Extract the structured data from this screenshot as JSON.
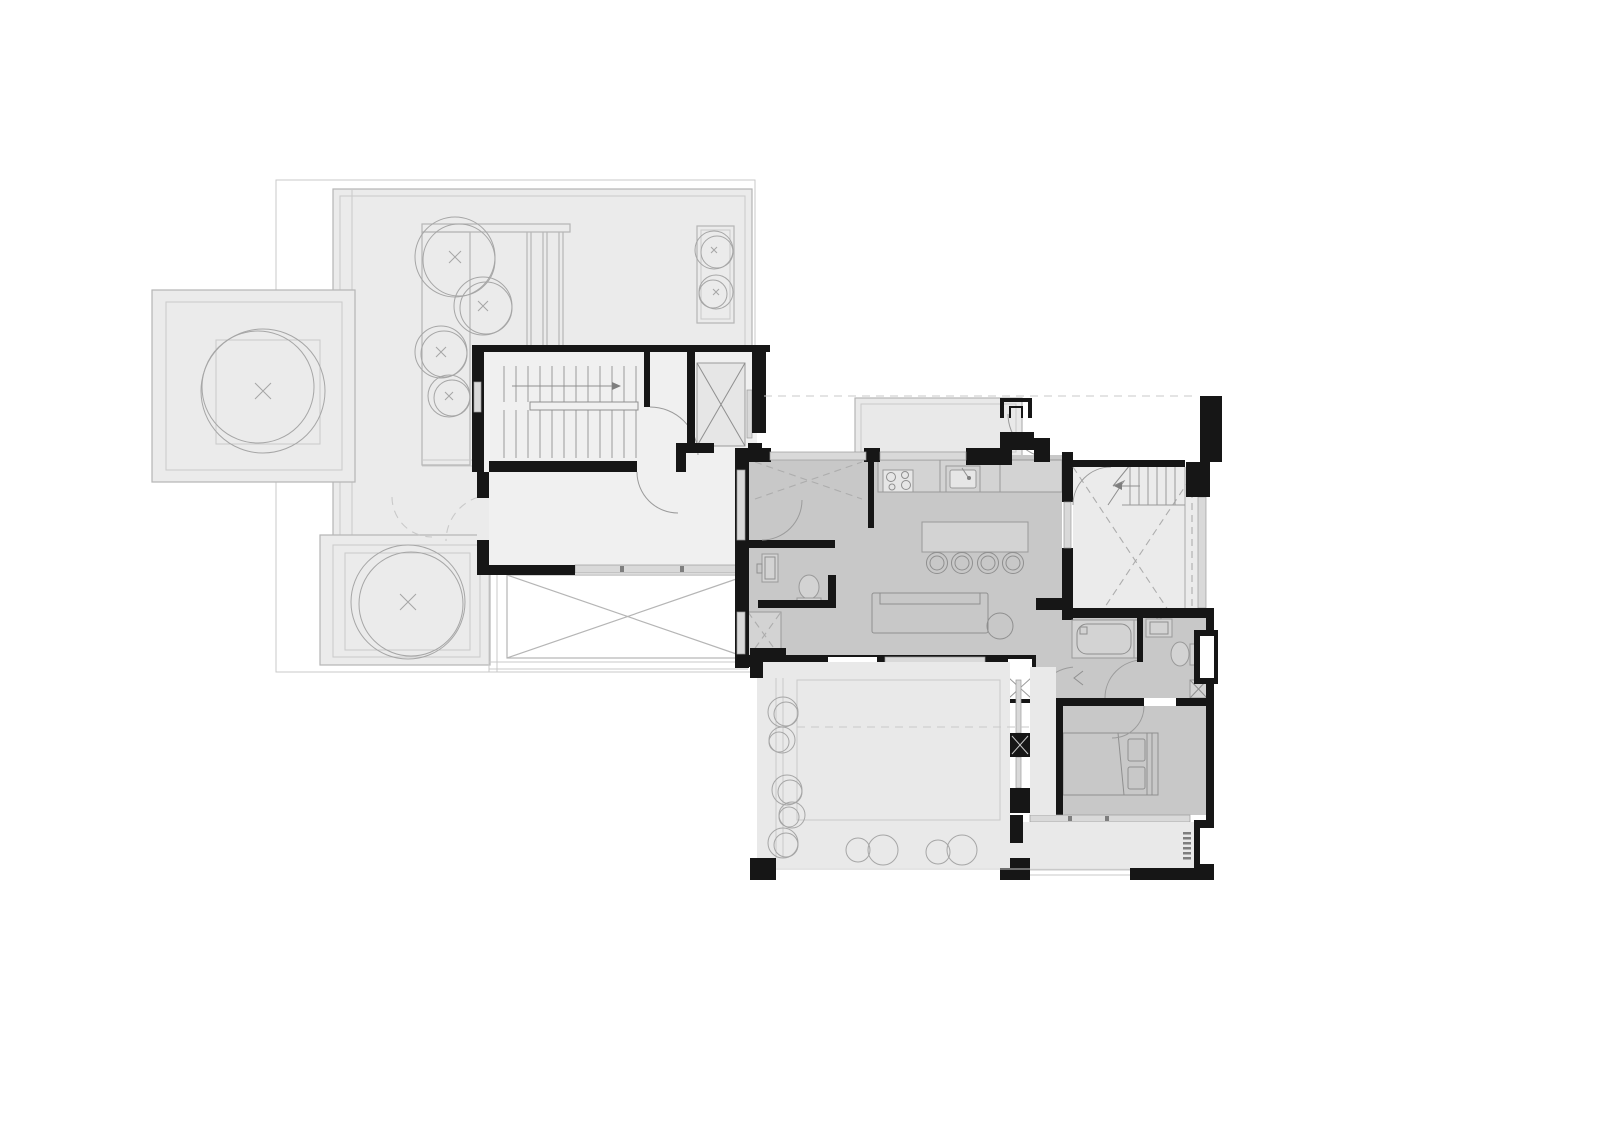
{
  "document": {
    "kind": "architectural-floor-plan",
    "visible_text": "none",
    "sheet": {
      "width_px": 1600,
      "height_px": 1131
    }
  },
  "palette": {
    "page_bg": "#ffffff",
    "wall": "#161616",
    "white": "#ffffff",
    "light_fill": "#ebebeb",
    "mid_fill": "#e9e9e9",
    "core_fill": "#f0f0f0",
    "dark_fill": "#c8c8c8",
    "deck_fill": "#efefef",
    "fixture_fill": "#d3d3d3",
    "fixture_light": "#e6e6e6",
    "band_fill": "#d9d9d9",
    "outline": "#b5b5b5",
    "faint": "#c9c9c9",
    "line": "#9a9a9a",
    "fixline": "#8f8f8f",
    "dash": "#adadad",
    "arcline": "#9b9b9b",
    "tree": "#a6a6a6"
  },
  "symbols": [
    "tree-canopy-circle-with-x",
    "planter-box",
    "pergola-slats",
    "stair-flight-with-up-arrow",
    "elevator-shaft-cross",
    "door-swing-arc",
    "dashed-roof-overhang-line",
    "skylight-cross",
    "double-height-void-dashed-cross",
    "break-line-zigzag",
    "kitchen-counter",
    "cooktop-four-burners",
    "kitchen-sink-with-faucet",
    "kitchen-island-with-four-stools",
    "sofa",
    "round-side-table",
    "powder-room-toilet",
    "wash-basin",
    "duct-shaft-cross-hatch",
    "bathtub",
    "bathroom-sink",
    "toilet",
    "double-bed-with-pillows",
    "window-band",
    "balcony-drain-hatch",
    "terrace-shrub-circles"
  ]
}
